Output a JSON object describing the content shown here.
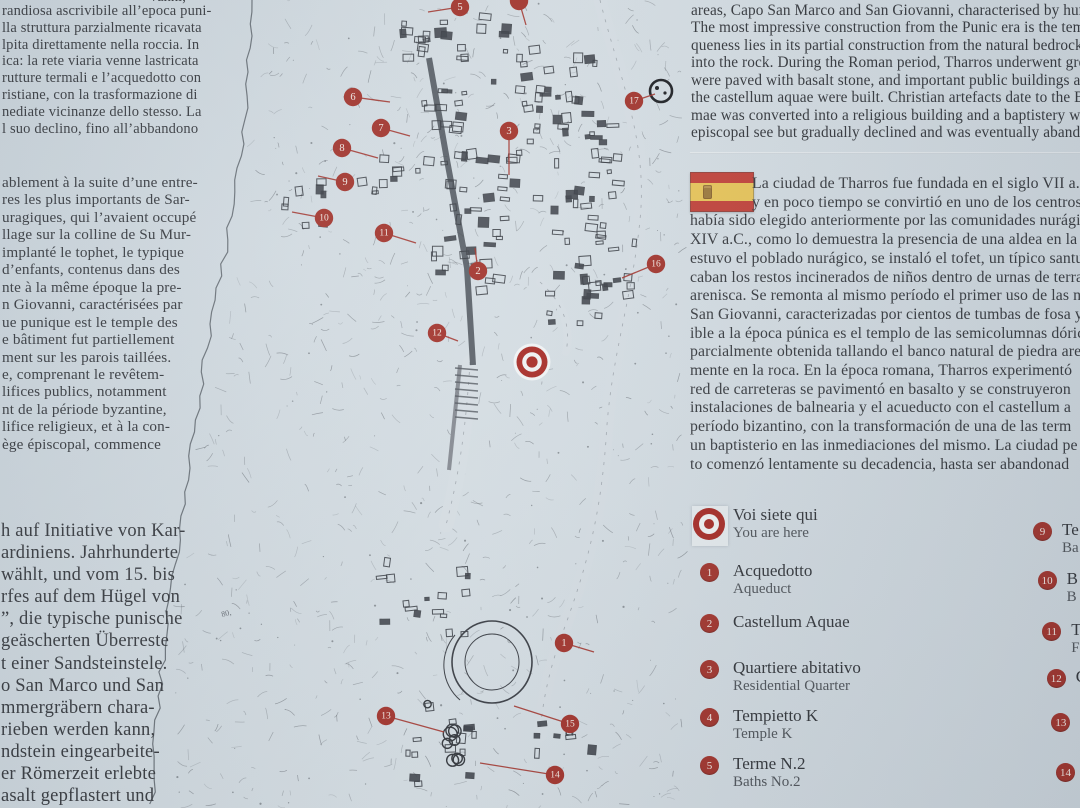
{
  "colors": {
    "bg": "#d3dce2",
    "accent_red": "#a02c24",
    "text": "#2f3237",
    "flag_red": "#c13a31",
    "flag_yellow": "#e9c452"
  },
  "left_column": {
    "top_fragment": "vanni,",
    "italian": [
      "randiosa ascrivibile all’epoca puni-",
      "lla struttura parzialmente ricavata",
      "lpita direttamente nella roccia. In",
      "ica: la rete viaria venne lastricata",
      "rutture termali e l’acquedotto con",
      "ristiane, con la trasformazione di",
      "nediate vicinanze dello stesso. La",
      "l suo declino, fino all’abbandono"
    ],
    "french": [
      "ablement à la suite d’une entre-",
      "res les plus importants de Sar-",
      "uragiques, qui l’avaient occupé",
      "llage sur la colline de Su Mur-",
      "implanté le tophet, le typique",
      "d’enfants, contenus dans des",
      "nte à la même époque la pre-",
      "n Giovanni, caractérisées par",
      "ue punique est le temple des",
      "e bâtiment fut partiellement",
      "ment sur les parois taillées.",
      "e, comprenant le revêtem-",
      "lifices publics, notamment",
      "nt de la période byzantine,",
      "lifice religieux, et à la con-",
      "ège épiscopal, commence"
    ],
    "german": [
      "h auf Initiative von Kar-",
      "ardiniens. Jahrhunderte",
      "wählt, und vom 15. bis",
      "rfes auf dem Hügel von",
      "”, die typische punische",
      "geäscherten Überreste",
      "t einer Sandsteinstele.",
      "o San Marco und San",
      "mmergräbern chara-",
      "rieben werden kann,",
      "ndstein eingearbeite-",
      "er Römerzeit erlebte",
      "asalt gepflastert und"
    ]
  },
  "right_column": {
    "english": [
      "areas, Capo San Marco and San Giovanni, characterised by hundre",
      "The most impressive construction from the Punic era is the temple",
      "queness lies in its partial construction from the natural bedrock a",
      "into the rock. During the Roman period, Tharros underwent great",
      "were paved with basalt stone, and important public buildings and",
      "the castellum aquae were built. Christian artefacts date to the By",
      "mae was converted into a religious building and a baptistery was",
      "episcopal see but gradually declined and was eventually abandon"
    ],
    "spanish": [
      "La ciudad de Tharros fue fundada en el siglo VII a.C.,",
      "y en poco tiempo se convirtió en uno de los centros",
      "había sido elegido anteriormente por las comunidades nurágic",
      "XIV a.C., como lo demuestra la presencia de una aldea en la co",
      "estuvo el poblado nurágico, se instaló el tofet, un típico santua",
      "caban los restos incinerados de niños dentro de urnas de terra",
      "arenisca. Se remonta al mismo período el primer uso de las ne",
      "San Giovanni, caracterizadas por cientos de tumbas de fosa y",
      "ible a la época púnica es el templo de las semicolumnas dóric",
      "parcialmente obtenida tallando el banco natural de piedra are",
      "mente en la roca. En la época romana, Tharros experimentó",
      "red de carreteras se pavimentó en basalto y se construyeron",
      "instalaciones de balnearia y el acueducto con el castellum a",
      "período bizantino, con la transformación de una de las term",
      "un baptisterio en las inmediaciones del mismo. La ciudad pe",
      "to comenzó lentamente su decadencia, hasta ser abandonad"
    ]
  },
  "legend": {
    "you_are_here": {
      "label": "Voi siete qui",
      "sub": "You are here"
    },
    "items": [
      {
        "n": "1",
        "label": "Acquedotto",
        "sub": "Aqueduct"
      },
      {
        "n": "2",
        "label": "Castellum Aquae",
        "sub": ""
      },
      {
        "n": "3",
        "label": "Quartiere abitativo",
        "sub": "Residential Quarter"
      },
      {
        "n": "4",
        "label": "Tempietto K",
        "sub": "Temple K"
      },
      {
        "n": "5",
        "label": "Terme N.2",
        "sub": "Baths No.2"
      }
    ],
    "right_items": [
      {
        "n": "9",
        "label": "Te",
        "sub": "Ba"
      },
      {
        "n": "10",
        "label": "B",
        "sub": "B"
      },
      {
        "n": "11",
        "label": "T",
        "sub": "F"
      },
      {
        "n": "12",
        "label": "C",
        "sub": ""
      },
      {
        "n": "13",
        "label": "",
        "sub": ""
      },
      {
        "n": "14",
        "label": "",
        "sub": ""
      }
    ]
  },
  "map": {
    "map_label": "80,",
    "you_are_here": {
      "x": 532,
      "y": 362
    },
    "markers": [
      {
        "n": "5",
        "x": 460,
        "y": 7,
        "lx": 428,
        "ly": 12
      },
      {
        "n": "",
        "x": 519,
        "y": 1,
        "lx": 526,
        "ly": 25
      },
      {
        "n": "6",
        "x": 353,
        "y": 97,
        "lx": 390,
        "ly": 102
      },
      {
        "n": "17",
        "x": 634,
        "y": 101,
        "lx": 655,
        "ly": 94
      },
      {
        "n": "7",
        "x": 381,
        "y": 128,
        "lx": 410,
        "ly": 136
      },
      {
        "n": "3",
        "x": 509,
        "y": 131,
        "lx": 509,
        "ly": 175
      },
      {
        "n": "8",
        "x": 342,
        "y": 148,
        "lx": 378,
        "ly": 158
      },
      {
        "n": "9",
        "x": 345,
        "y": 182,
        "lx": 318,
        "ly": 176
      },
      {
        "n": "10",
        "x": 324,
        "y": 218,
        "lx": 292,
        "ly": 212
      },
      {
        "n": "11",
        "x": 384,
        "y": 233,
        "lx": 416,
        "ly": 243
      },
      {
        "n": "2",
        "x": 478,
        "y": 271,
        "lx": 475,
        "ly": 248
      },
      {
        "n": "16",
        "x": 656,
        "y": 264,
        "lx": 622,
        "ly": 278
      },
      {
        "n": "12",
        "x": 437,
        "y": 333,
        "lx": 458,
        "ly": 341
      },
      {
        "n": "1",
        "x": 564,
        "y": 643,
        "lx": 594,
        "ly": 652
      },
      {
        "n": "13",
        "x": 386,
        "y": 716,
        "lx": 444,
        "ly": 732
      },
      {
        "n": "15",
        "x": 570,
        "y": 724,
        "lx": 514,
        "ly": 706
      },
      {
        "n": "14",
        "x": 555,
        "y": 775,
        "lx": 480,
        "ly": 763
      }
    ]
  }
}
